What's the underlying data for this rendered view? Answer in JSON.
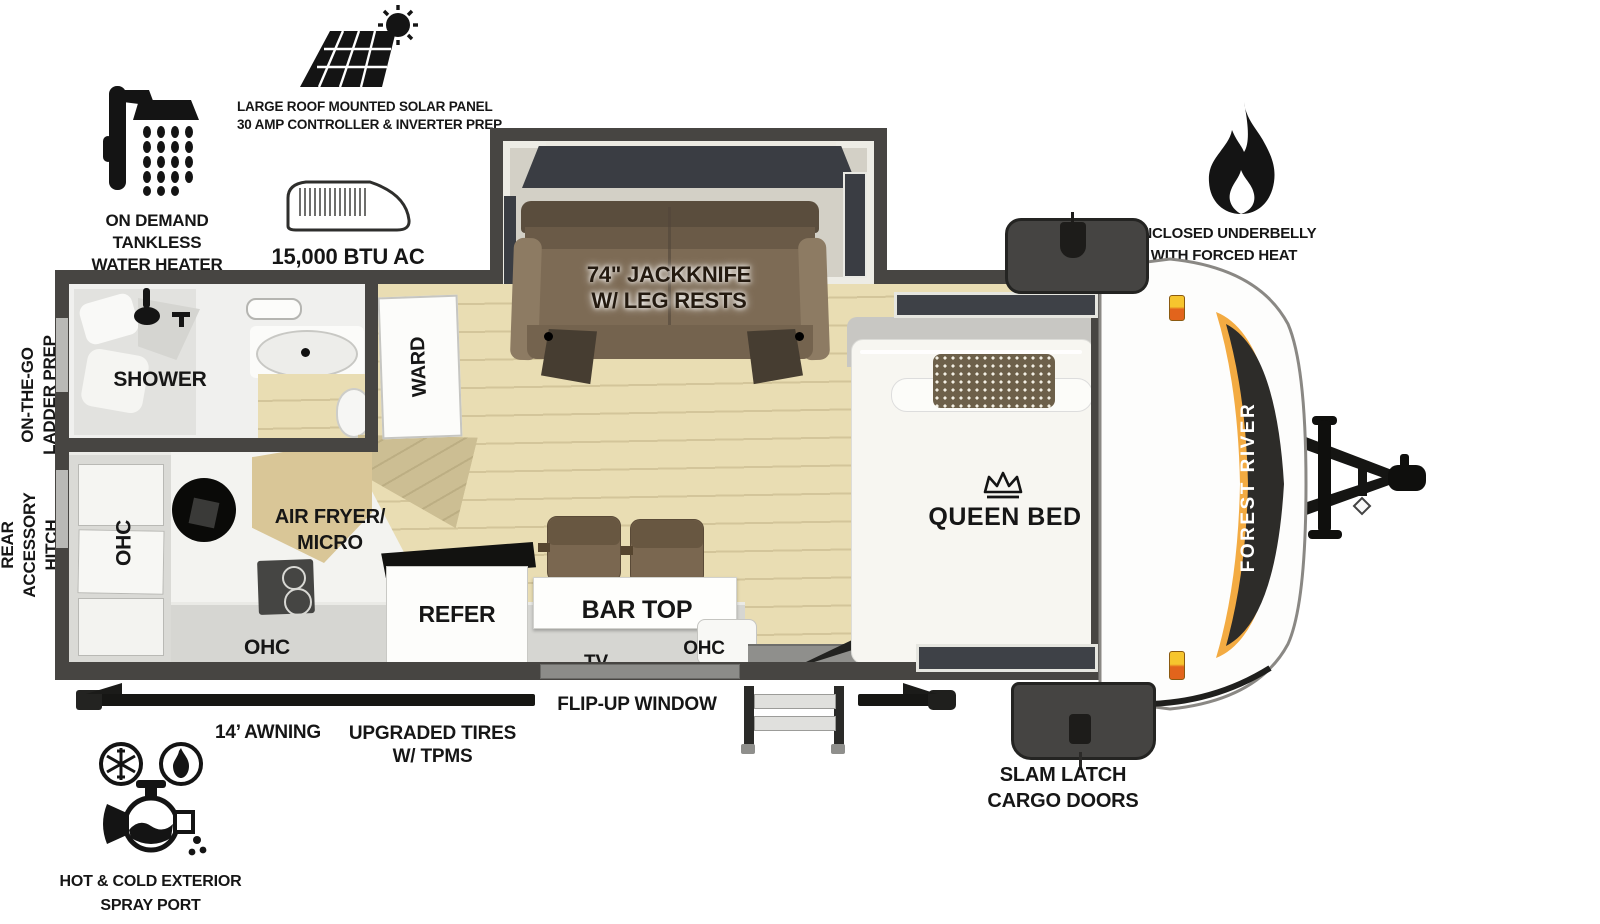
{
  "brand": "FOREST RIVER",
  "features": {
    "water_heater": {
      "lines": [
        "ON DEMAND",
        "TANKLESS",
        "WATER HEATER"
      ]
    },
    "solar": {
      "lines": [
        "LARGE ROOF MOUNTED SOLAR PANEL",
        "30 AMP CONTROLLER & INVERTER PREP"
      ]
    },
    "ac": {
      "label": "15,000 BTU AC"
    },
    "underbelly": {
      "lines": [
        "ENCLOSED UNDERBELLY",
        "WITH FORCED HEAT"
      ]
    },
    "spray_port": {
      "lines": [
        "HOT & COLD EXTERIOR",
        "SPRAY PORT"
      ]
    },
    "awning": {
      "label": "14’ AWNING"
    },
    "tires": {
      "lines": [
        "UPGRADED TIRES",
        "W/ TPMS"
      ]
    },
    "flip_window": {
      "label": "FLIP-UP WINDOW"
    },
    "cargo_doors": {
      "lines": [
        "SLAM LATCH",
        "CARGO DOORS"
      ]
    },
    "ladder_prep": {
      "lines": [
        "ON-THE-GO",
        "LADDER PREP"
      ]
    },
    "rear_hitch": {
      "lines": [
        "REAR",
        "ACCESSORY",
        "HITCH"
      ]
    }
  },
  "interior": {
    "shower": "SHOWER",
    "ward": "WARD",
    "sofa": {
      "lines": [
        "74\" JACKKNIFE",
        "W/ LEG RESTS"
      ]
    },
    "queen_bed": "QUEEN BED",
    "ohc_left": "OHC",
    "ohc_kitchen": "OHC",
    "ohc_bar": "OHC",
    "air_fryer": {
      "lines": [
        "AIR FRYER/",
        "MICRO"
      ]
    },
    "refer": "REFER",
    "bar_top": "BAR TOP",
    "tv": "TV"
  },
  "colors": {
    "wall": "#474542",
    "floor": "#e9ddb3",
    "sofa_brown": "#7d6b55",
    "accent_orange": "#f3ab42",
    "marker_light": "#e2641c"
  }
}
